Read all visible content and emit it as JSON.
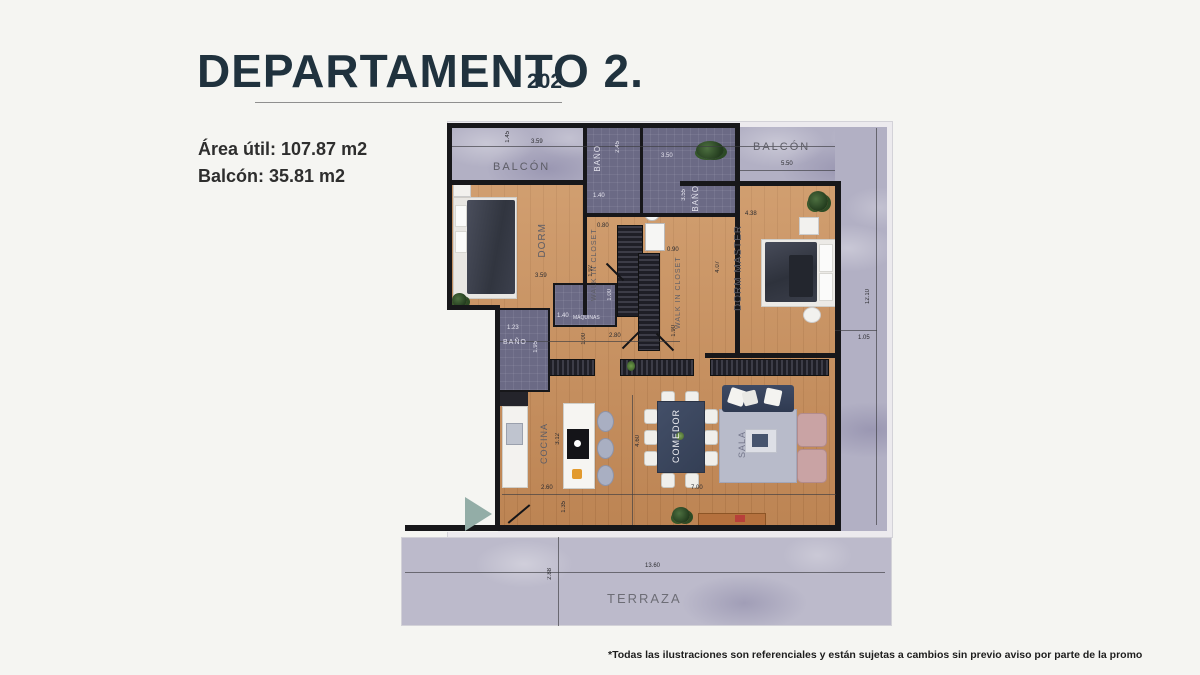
{
  "header": {
    "title": "DEPARTAMENTO 2.",
    "unit_number": "202",
    "area_util": "Área útil: 107.87 m2",
    "balcon": "Balcón: 35.81 m2"
  },
  "plan": {
    "rooms": {
      "balcon_left": "BALCÓN",
      "balcon_right": "BALCÓN",
      "bano_1": "BAÑO",
      "bano_2": "BAÑO",
      "bano_3": "BAÑO",
      "dorm": "DORM",
      "walkin_1": "WALK IN CLOSET",
      "walkin_2": "WALK IN CLOSET",
      "dorm_master": "DORM MASTER",
      "maquinas": "MÁQUINAS",
      "cocina": "COCINA",
      "comedor": "COMEDOR",
      "sala": "SALA",
      "terraza": "TERRAZA"
    },
    "dims": {
      "top_height": "1.45",
      "balcon_left_width": "3.59",
      "bano1_height": "2.45",
      "bano1_width": "1.40",
      "bano2_width": "3.50",
      "bano2_height": "3.55",
      "balcon_right_width": "5.50",
      "dorm_width": "3.59",
      "wic1_width": "0.80",
      "wic1_height": "1.92",
      "bano3_width": "1.23",
      "bano3_height": "1.95",
      "maquinas_width": "1.40",
      "maquinas_height": "1.00",
      "hall_width": "2.80",
      "hall_height": "1.00",
      "wic2_width": "0.90",
      "wic2_height": "1.90",
      "dorm_master_width": "4.38",
      "dorm_master_height": "4.07",
      "right_height": "12.10",
      "right_offset": "1.05",
      "cocina_height": "3.12",
      "kitchen_width": "2.60",
      "entry_height": "1.35",
      "living_height": "4.60",
      "living_width": "7.00",
      "terraza_width": "13.60",
      "terraza_height": "2.88"
    }
  },
  "footer": {
    "disclaimer": "*Todas las ilustraciones son referenciales y están sujetas a cambios sin previo aviso por parte de la promo"
  },
  "colors": {
    "title": "#20323e",
    "wood_floor": "#c68e5c",
    "concrete": "#b2b0c4",
    "tile": "#6b6a85",
    "navy_furniture": "#3d4a63",
    "pink_armchair": "#c9a3a4",
    "triangle": "#93ada7"
  }
}
